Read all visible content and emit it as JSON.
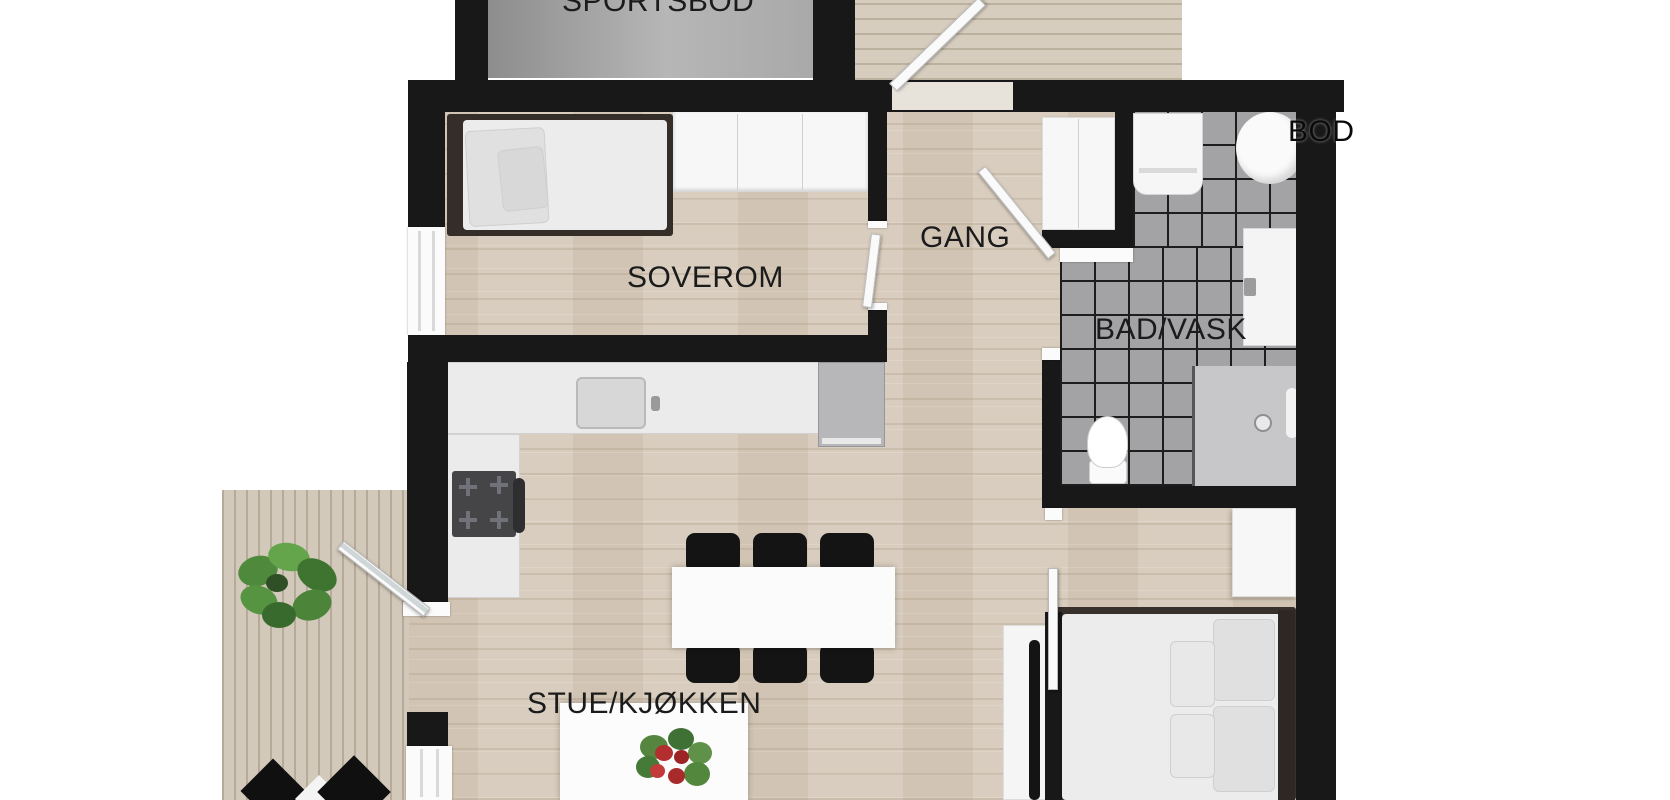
{
  "plan": {
    "type": "apartment-floorplan",
    "rooms": {
      "sportsbod": {
        "label": "SPORTSBOD"
      },
      "soverom": {
        "label": "SOVEROM"
      },
      "gang": {
        "label": "GANG"
      },
      "bad_vask": {
        "label": "BAD/VASK"
      },
      "bod": {
        "label": "BOD"
      },
      "stue_kjokken": {
        "label": "STUE/KJØKKEN"
      }
    },
    "colors": {
      "wall": "#181818",
      "wood_floor": "#d8cdbe",
      "tile_floor": "#a3a3a6",
      "storage_floor": "#a9a9a9",
      "deck": "#d6cdbe",
      "label_text": "#1b1b1b"
    }
  }
}
